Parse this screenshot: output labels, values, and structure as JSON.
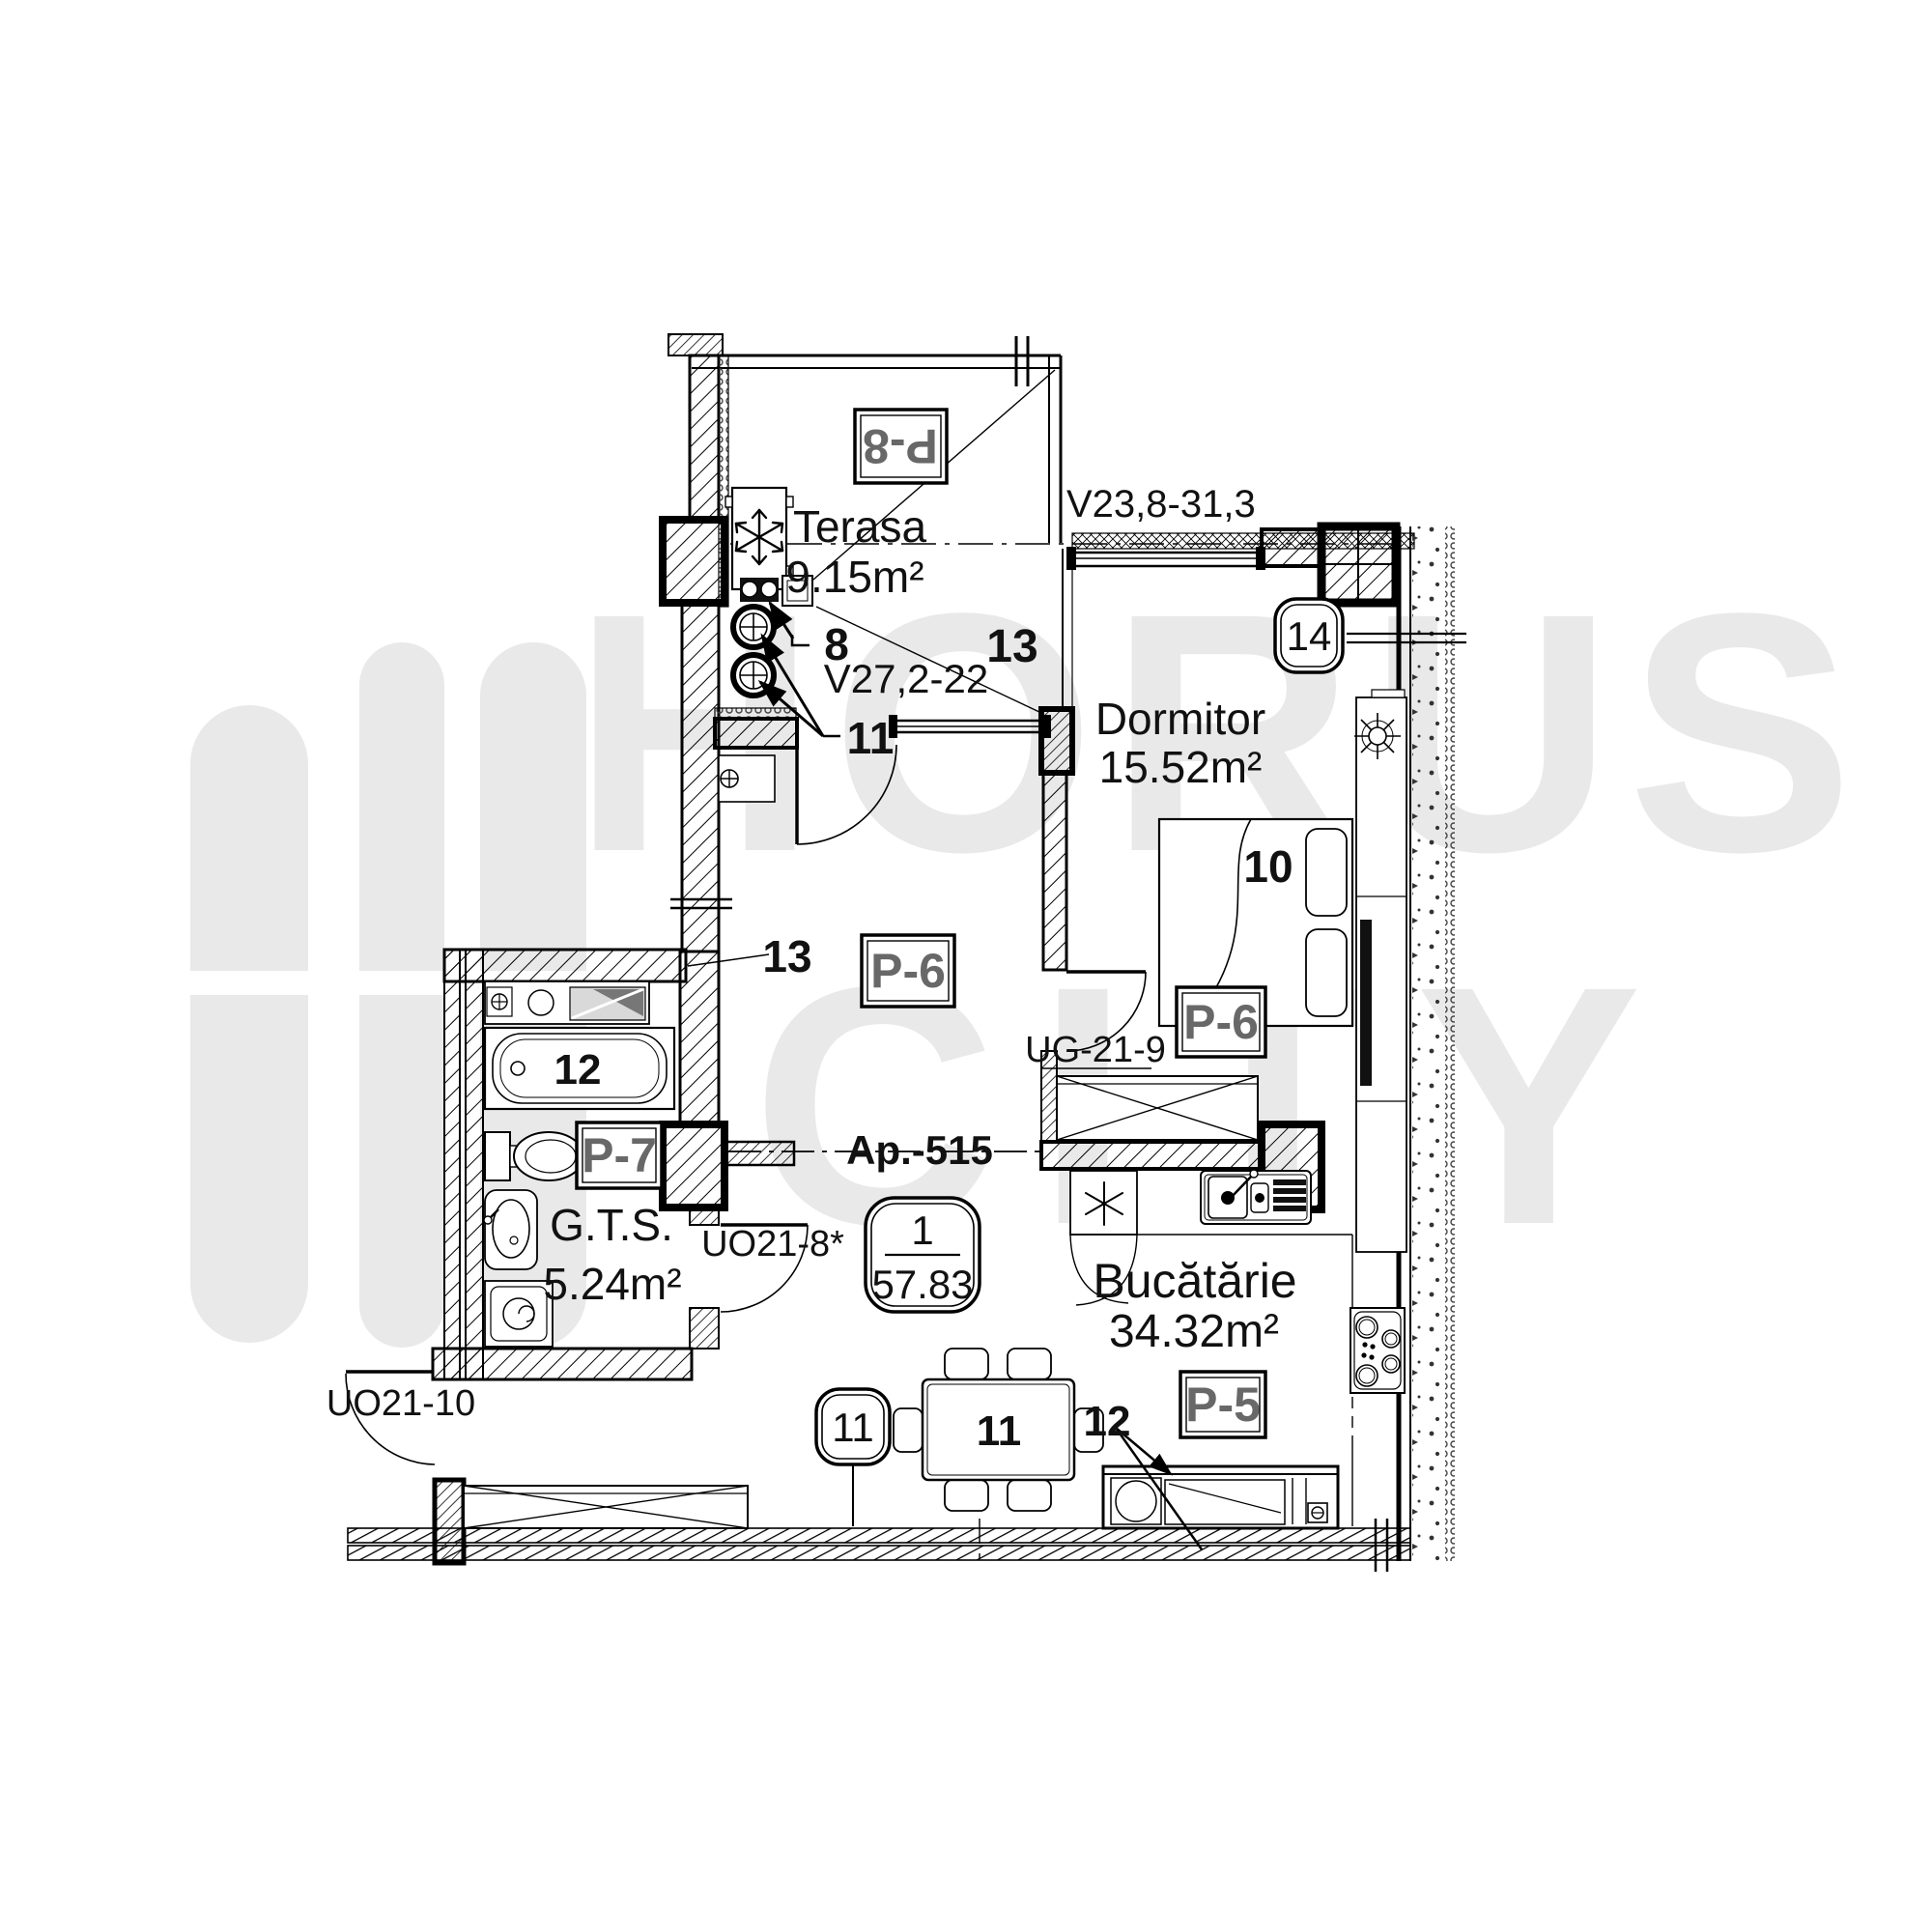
{
  "watermark": {
    "brand_top": "HORUS",
    "brand_bottom": "CITY"
  },
  "apartment": {
    "code_label": "Ap.-515",
    "unit_number": "1",
    "total_area": "57.83"
  },
  "rooms": {
    "terasa": {
      "name": "Terasa",
      "area": "9.15m²"
    },
    "dormitor": {
      "name": "Dormitor",
      "area": "15.52m²"
    },
    "bucatarie": {
      "name": "Bucătărie",
      "area": "34.32m²"
    },
    "gts": {
      "name": "G.T.S.",
      "area": "5.24m²"
    }
  },
  "partition_labels": {
    "p8": "P-8",
    "p6_hall": "P-6",
    "p6_dormitor": "P-6",
    "p7": "P-7",
    "p5": "P-5"
  },
  "opening_codes": {
    "terasa_window": "V27,2-22",
    "dormitor_window": "V23,8-31,3",
    "dormitor_wardrobe": "UG-21-9",
    "bathroom_door": "UO21-8*",
    "entry_door": "UO21-10"
  },
  "item_numbers": {
    "n8": "8",
    "n10": "10",
    "n11_risers": "11",
    "n11_table": "11",
    "n12_bathtub": "12",
    "n12_sofa": "12",
    "n13_terasa": "13",
    "n13_hall": "13",
    "badge_14": "14",
    "badge_11": "11"
  }
}
